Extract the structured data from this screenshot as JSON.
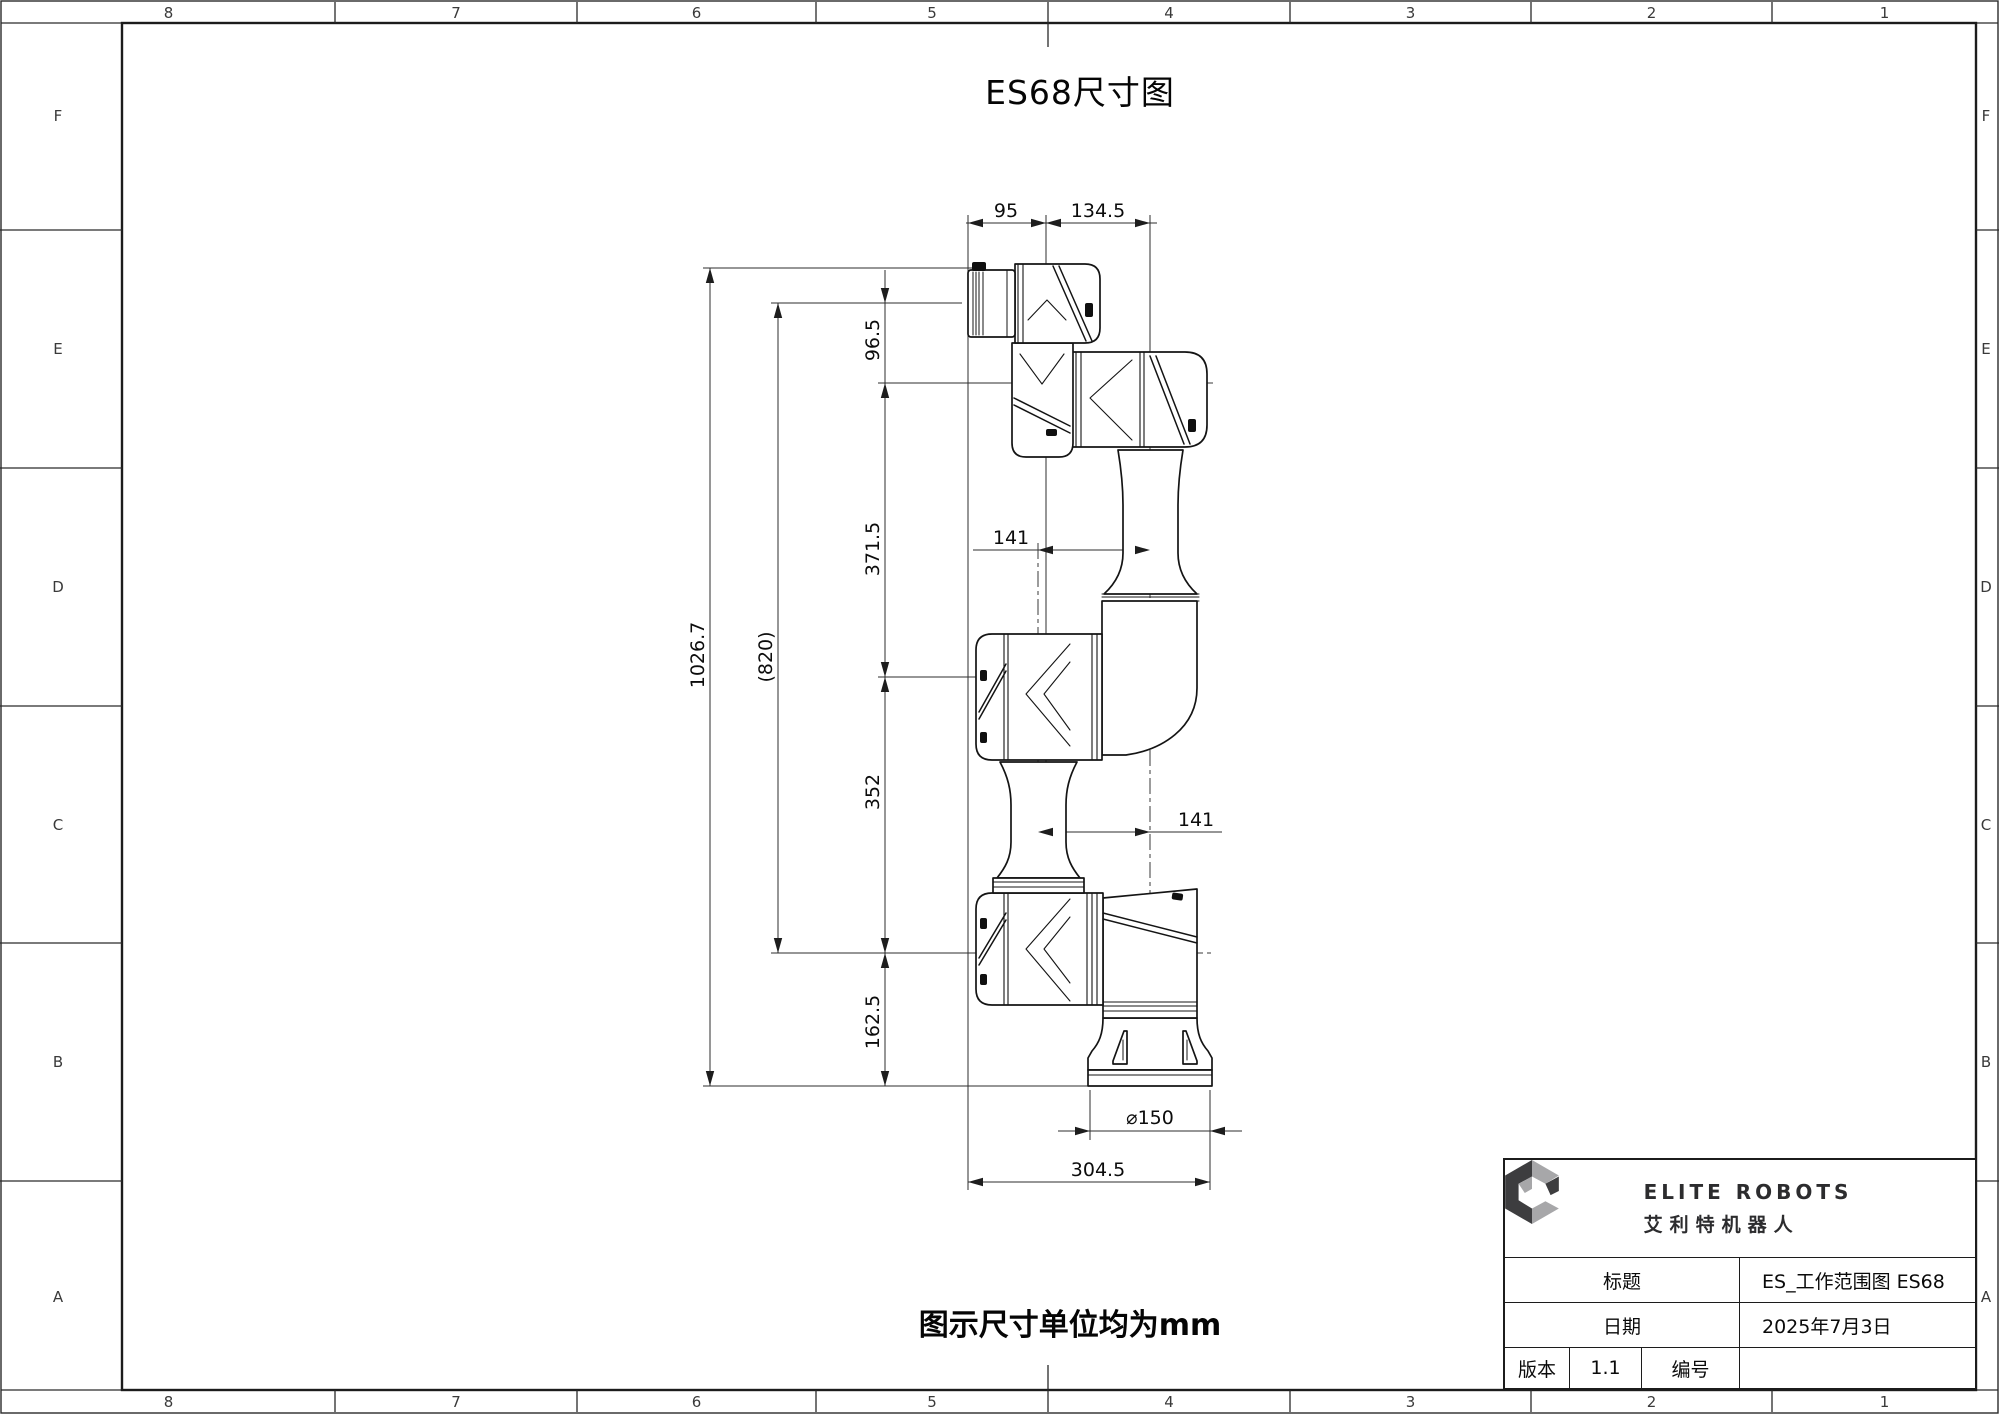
{
  "sheet": {
    "title": "ES68尺寸图",
    "note": "图示尺寸单位均为mm",
    "zone_columns": [
      "8",
      "7",
      "6",
      "5",
      "4",
      "3",
      "2",
      "1"
    ],
    "zone_rows": [
      "F",
      "E",
      "D",
      "C",
      "B",
      "A"
    ]
  },
  "dims": {
    "top_95": "95",
    "top_134_5": "134.5",
    "left_1026_7": "1026.7",
    "left_820": "(820)",
    "left_96_5": "96.5",
    "left_371_5": "371.5",
    "left_352": "352",
    "left_162_5": "162.5",
    "mid_141_upper": "141",
    "mid_141_lower": "141",
    "bottom_dia_150": "⌀150",
    "bottom_304_5": "304.5"
  },
  "title_block": {
    "logo_en": "ELITE ROBOTS",
    "logo_cn": "艾利特机器人",
    "title_label": "标题",
    "title_value": "ES_工作范围图  ES68",
    "date_label": "日期",
    "date_value": "2025年7月3日",
    "version_label": "版本",
    "version_value": "1.1",
    "number_label": "编号",
    "number_value": ""
  },
  "colors": {
    "line": "#141414",
    "dim_line": "#2e2e2e",
    "logo_dark": "#3d3d3f",
    "logo_light": "#a7a7a9",
    "background": "#ffffff"
  }
}
